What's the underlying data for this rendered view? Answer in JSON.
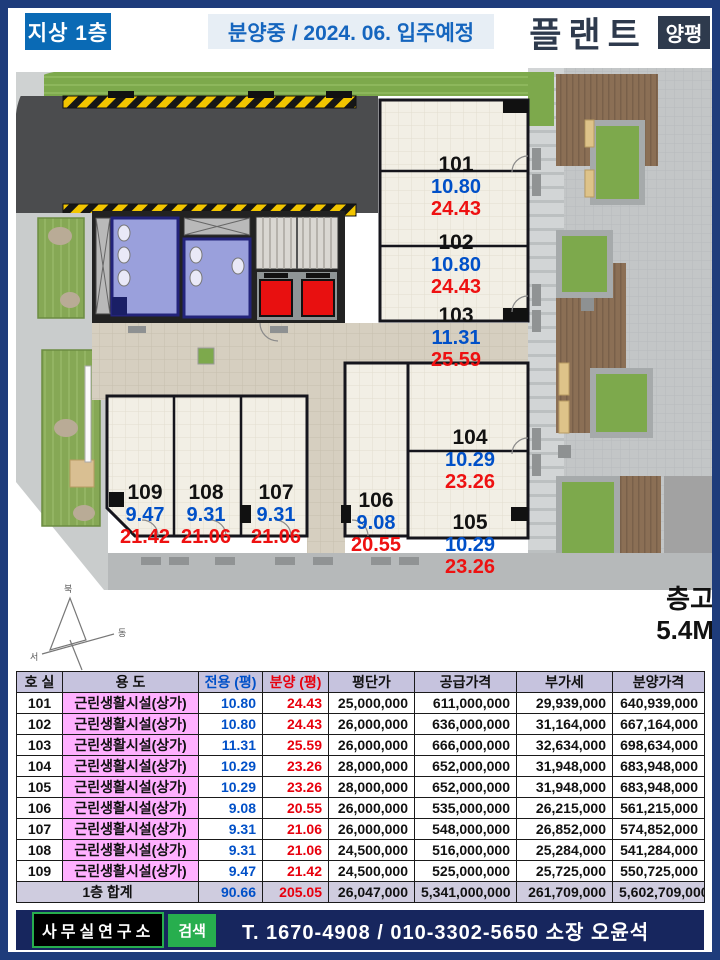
{
  "header": {
    "floor_badge": "지상 1층",
    "status": "분양중 / 2024. 06. 입주예정",
    "brand": "플랜트",
    "brand_badge": "양평"
  },
  "plan": {
    "units": [
      {
        "no": "101",
        "exclusive": "10.80",
        "supply": "24.43"
      },
      {
        "no": "102",
        "exclusive": "10.80",
        "supply": "24.43"
      },
      {
        "no": "103",
        "exclusive": "11.31",
        "supply": "25.59"
      },
      {
        "no": "104",
        "exclusive": "10.29",
        "supply": "23.26"
      },
      {
        "no": "105",
        "exclusive": "10.29",
        "supply": "23.26"
      },
      {
        "no": "106",
        "exclusive": "9.08",
        "supply": "20.55"
      },
      {
        "no": "107",
        "exclusive": "9.31",
        "supply": "21.06"
      },
      {
        "no": "108",
        "exclusive": "9.31",
        "supply": "21.06"
      },
      {
        "no": "109",
        "exclusive": "9.47",
        "supply": "21.42"
      }
    ],
    "compass": {
      "north": "북",
      "east": "동",
      "west": "서",
      "south": "남"
    },
    "ceiling_label": "층고",
    "ceiling_value": "5.4M",
    "colors": {
      "unit_number": "#111111",
      "exclusive_area": "#0050c8",
      "supply_area": "#ee1111",
      "restroom": "#9aa0dc",
      "elevator": "#e81010",
      "grass": "#7da94c",
      "deck": "#8b6f55",
      "road": "#4b4c4e",
      "hazard_yellow": "#f2c500"
    }
  },
  "table": {
    "headers": [
      "호 실",
      "용 도",
      "전용 (평)",
      "분양 (평)",
      "평단가",
      "공급가격",
      "부가세",
      "분양가격"
    ],
    "rows": [
      [
        "101",
        "근린생활시설(상가)",
        "10.80",
        "24.43",
        "25,000,000",
        "611,000,000",
        "29,939,000",
        "640,939,000"
      ],
      [
        "102",
        "근린생활시설(상가)",
        "10.80",
        "24.43",
        "26,000,000",
        "636,000,000",
        "31,164,000",
        "667,164,000"
      ],
      [
        "103",
        "근린생활시설(상가)",
        "11.31",
        "25.59",
        "26,000,000",
        "666,000,000",
        "32,634,000",
        "698,634,000"
      ],
      [
        "104",
        "근린생활시설(상가)",
        "10.29",
        "23.26",
        "28,000,000",
        "652,000,000",
        "31,948,000",
        "683,948,000"
      ],
      [
        "105",
        "근린생활시설(상가)",
        "10.29",
        "23.26",
        "28,000,000",
        "652,000,000",
        "31,948,000",
        "683,948,000"
      ],
      [
        "106",
        "근린생활시설(상가)",
        "9.08",
        "20.55",
        "26,000,000",
        "535,000,000",
        "26,215,000",
        "561,215,000"
      ],
      [
        "107",
        "근린생활시설(상가)",
        "9.31",
        "21.06",
        "26,000,000",
        "548,000,000",
        "26,852,000",
        "574,852,000"
      ],
      [
        "108",
        "근린생활시설(상가)",
        "9.31",
        "21.06",
        "24,500,000",
        "516,000,000",
        "25,284,000",
        "541,284,000"
      ],
      [
        "109",
        "근린생활시설(상가)",
        "9.47",
        "21.42",
        "24,500,000",
        "525,000,000",
        "25,725,000",
        "550,725,000"
      ]
    ],
    "total": {
      "label": "1층 합계",
      "exclusive": "90.66",
      "supply": "205.05",
      "values": [
        "26,047,000",
        "5,341,000,000",
        "261,709,000",
        "5,602,709,000"
      ]
    },
    "colors": {
      "header_bg": "#c6c3de",
      "use_bg": "#ffb0ff",
      "total_bg": "#cfccdf"
    }
  },
  "footer": {
    "company": "사무실연구소",
    "search_label": "검색",
    "contact": "T. 1670-4908  /  010-3302-5650  소장 오윤석",
    "colors": {
      "bar_bg": "#17265e",
      "green": "#27ae4e"
    }
  }
}
